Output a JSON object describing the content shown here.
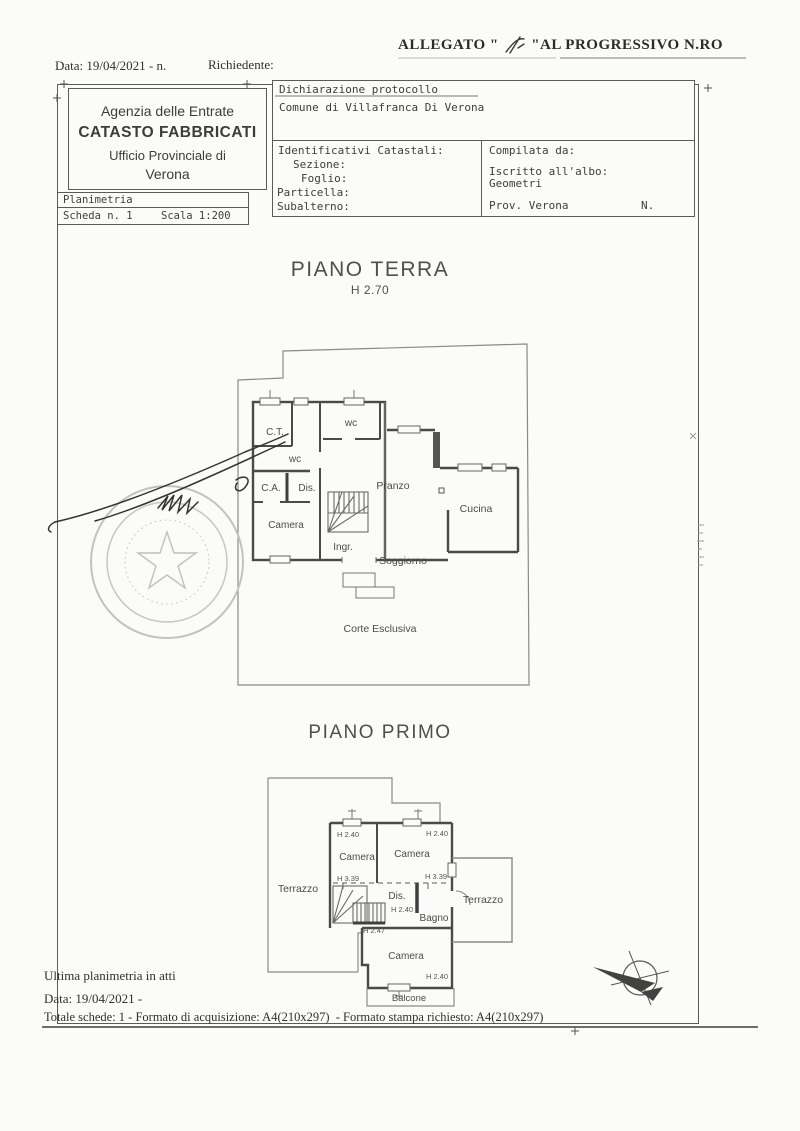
{
  "colors": {
    "paper": "#fbfbf9",
    "ink": "#3d3d3d",
    "plan_line": "#4a4a4a",
    "stamp": "#c2c2c2"
  },
  "page": {
    "allegato_left": "ALLEGATO \" ",
    "allegato_right": " \"AL PROGRESSIVO N.RO",
    "date_line": "Data: 19/04/2021 - n.",
    "richiedente": "Richiedente:"
  },
  "office": {
    "line1": "Agenzia delle Entrate",
    "line2": "CATASTO FABBRICATI",
    "line3": "Ufficio Provinciale di",
    "line4": "Verona"
  },
  "scheda": {
    "planimetria": "Planimetria",
    "scheda_n": "Scheda n. 1",
    "scala": "Scala 1:200"
  },
  "protocol": {
    "title": "Dichiarazione protocollo",
    "comune": "Comune di Villafranca Di Verona"
  },
  "catastali": {
    "title": "Identificativi Catastali:",
    "sezione": "Sezione:",
    "foglio": "Foglio:",
    "particella": "Particella:",
    "subalterno": "Subalterno:"
  },
  "compilata": {
    "title": "Compilata da:",
    "albo": "Iscritto all'albo:",
    "geometri": "Geometri",
    "prov": "Prov. Verona",
    "n": "N."
  },
  "ground_floor": {
    "title": "PIANO TERRA",
    "height": "H 2.70",
    "labels": {
      "ct": "C.T.",
      "wc1": "wc",
      "wc2": "wc",
      "ca": "C.A.",
      "dis": "Dis.",
      "pranzo": "Pranzo",
      "cucina": "Cucina",
      "camera": "Camera",
      "ingr": "Ingr.",
      "soggiorno": "Soggiorno",
      "corte": "Corte Esclusiva"
    }
  },
  "first_floor": {
    "title": "PIANO PRIMO",
    "labels": {
      "h240_tl": "H 2.40",
      "h240_tr": "H 2.40",
      "camera_l": "Camera",
      "camera_r": "Camera",
      "terrazzo_l": "Terrazzo",
      "h339_l": "H 3.39",
      "h339_r": "H 3.39",
      "dis": "Dis.",
      "h240_dis": "H 2.40",
      "bagno": "Bagno",
      "terrazzo_r": "Terrazzo",
      "h247": "H 2.47",
      "camera_b": "Camera",
      "h240_b": "H 2.40",
      "balcone": "Balcone"
    }
  },
  "footer": {
    "line1": "Ultima planimetria in atti",
    "line2": "Data: 19/04/2021 -",
    "line3": "Totale schede: 1 - Formato di acquisizione: A4(210x297)  - Formato stampa richiesto: A4(210x297)"
  }
}
